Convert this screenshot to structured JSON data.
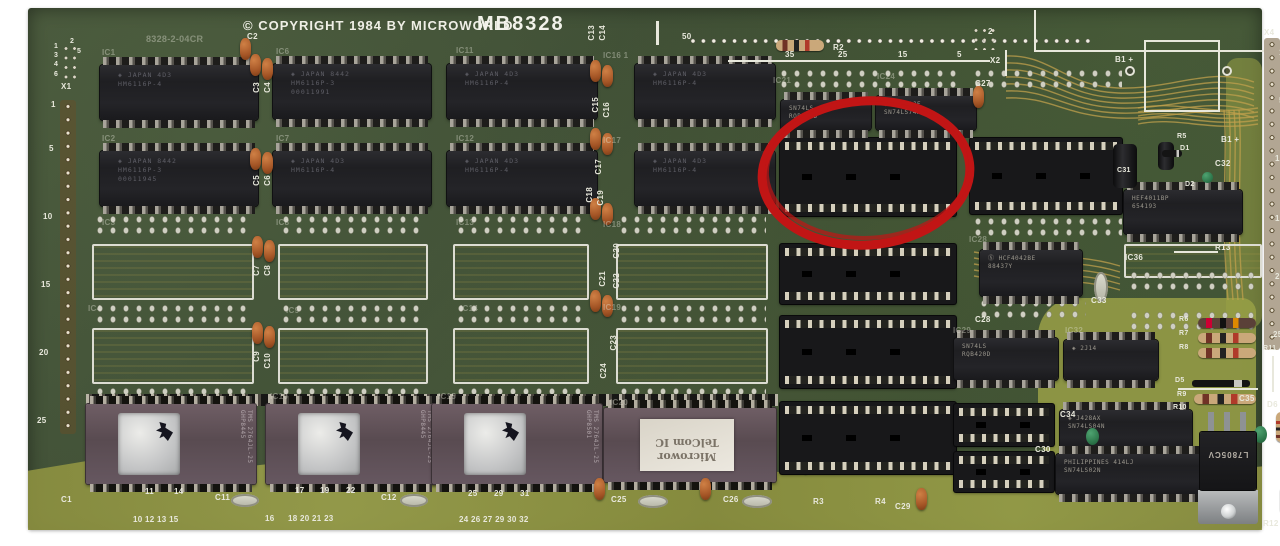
{
  "title": {
    "copyright": "© COPYRIGHT 1984 BY MICROWORLD",
    "model": "MB8328"
  },
  "colors": {
    "board_green": "#44523a",
    "silkscreen": "#e8e8dc",
    "trace_gold": "#c0a04c",
    "annotation_red": "#c11515"
  },
  "annotation": {
    "cx": 838,
    "cy": 165,
    "rx": 104,
    "ry": 72,
    "rot": -4,
    "color": "#c11515",
    "width": 9
  },
  "ram_chips": [
    {
      "x": 72,
      "y": 57,
      "w": 158,
      "h": 55,
      "l": [
        "◈ JAPAN 4D3",
        "HM6116P-4"
      ]
    },
    {
      "x": 245,
      "y": 56,
      "w": 158,
      "h": 55,
      "l": [
        "◈ JAPAN 8442",
        "HM6116P-3",
        "00011991"
      ]
    },
    {
      "x": 419,
      "y": 56,
      "w": 150,
      "h": 55,
      "l": [
        "◈ JAPAN 4D3",
        "HM6116P-4"
      ]
    },
    {
      "x": 607,
      "y": 56,
      "w": 140,
      "h": 55,
      "l": [
        "◈ JAPAN 4D3",
        "HM6116P-4"
      ]
    },
    {
      "x": 72,
      "y": 143,
      "w": 158,
      "h": 55,
      "l": [
        "◈ JAPAN 8442",
        "HM6116P-3",
        "00011945"
      ]
    },
    {
      "x": 245,
      "y": 143,
      "w": 158,
      "h": 55,
      "l": [
        "◈ JAPAN 4D3",
        "HM6116P-4"
      ]
    },
    {
      "x": 419,
      "y": 143,
      "w": 150,
      "h": 55,
      "l": [
        "◈ JAPAN 4D3",
        "HM6116P-4"
      ]
    },
    {
      "x": 607,
      "y": 143,
      "w": 140,
      "h": 55,
      "l": [
        "◈ JAPAN 4D3",
        "HM6116P-4"
      ]
    }
  ],
  "small_chips": [
    {
      "x": 753,
      "y": 92,
      "w": 90,
      "h": 30,
      "l": [
        "SN74LS",
        "RQB420D"
      ]
    },
    {
      "x": 848,
      "y": 88,
      "w": 100,
      "h": 34,
      "l": [
        "◈ J445AJF",
        "SN74LS74AN"
      ]
    },
    {
      "x": 952,
      "y": 242,
      "w": 102,
      "h": 46,
      "l": [
        "Ⓢ HCF4042BE",
        "88437Y"
      ]
    },
    {
      "x": 926,
      "y": 330,
      "w": 104,
      "h": 42,
      "l": [
        "SN74LS",
        "RQB420D"
      ]
    },
    {
      "x": 1036,
      "y": 332,
      "w": 94,
      "h": 40,
      "l": [
        "◈ 2J14"
      ]
    },
    {
      "x": 1096,
      "y": 182,
      "w": 118,
      "h": 44,
      "l": [
        "HEF4011BP",
        "654193"
      ]
    },
    {
      "x": 1032,
      "y": 402,
      "w": 132,
      "h": 40,
      "l": [
        "◈ J428AX",
        "SN74LS04N"
      ]
    },
    {
      "x": 1028,
      "y": 446,
      "w": 148,
      "h": 40,
      "l": [
        "PHILIPPINES 414LJ",
        "SN74LS02N"
      ]
    }
  ],
  "sockets": [
    {
      "x": 752,
      "y": 130,
      "w": 176,
      "h": 78
    },
    {
      "x": 752,
      "y": 236,
      "w": 176,
      "h": 60
    },
    {
      "x": 752,
      "y": 308,
      "w": 176,
      "h": 72
    },
    {
      "x": 752,
      "y": 394,
      "w": 176,
      "h": 72
    },
    {
      "x": 942,
      "y": 130,
      "w": 152,
      "h": 76
    },
    {
      "x": 926,
      "y": 396,
      "w": 100,
      "h": 42
    },
    {
      "x": 926,
      "y": 444,
      "w": 100,
      "h": 40
    }
  ],
  "eproms": [
    {
      "x": 58,
      "y": 396,
      "w": 170,
      "h": 80,
      "side": "TMS 2764JL-25 GHP8445"
    },
    {
      "x": 238,
      "y": 396,
      "w": 170,
      "h": 80,
      "side": "TMS 2764JL-25 GHP8445"
    },
    {
      "x": 404,
      "y": 396,
      "w": 170,
      "h": 80,
      "side": "TMS 2764JL-25 GHP8501"
    },
    {
      "x": 576,
      "y": 400,
      "w": 172,
      "h": 74,
      "type": "label",
      "lines": [
        "Microwor",
        "TelCom IC"
      ]
    }
  ],
  "footprints": [
    {
      "x": 64,
      "y": 236,
      "w": 162,
      "h": 56
    },
    {
      "x": 250,
      "y": 236,
      "w": 150,
      "h": 56
    },
    {
      "x": 425,
      "y": 236,
      "w": 136,
      "h": 56
    },
    {
      "x": 588,
      "y": 236,
      "w": 152,
      "h": 56
    },
    {
      "x": 64,
      "y": 320,
      "w": 162,
      "h": 56
    },
    {
      "x": 250,
      "y": 320,
      "w": 150,
      "h": 56
    },
    {
      "x": 425,
      "y": 320,
      "w": 136,
      "h": 56
    },
    {
      "x": 588,
      "y": 320,
      "w": 152,
      "h": 56
    },
    {
      "x": 1096,
      "y": 236,
      "w": 138,
      "h": 34
    }
  ],
  "pad_rows": [
    {
      "x": 66,
      "y": 206,
      "w": 158
    },
    {
      "x": 252,
      "y": 206,
      "w": 146
    },
    {
      "x": 427,
      "y": 206,
      "w": 132
    },
    {
      "x": 590,
      "y": 206,
      "w": 148
    },
    {
      "x": 66,
      "y": 295,
      "w": 158
    },
    {
      "x": 252,
      "y": 295,
      "w": 146
    },
    {
      "x": 427,
      "y": 295,
      "w": 132
    },
    {
      "x": 590,
      "y": 295,
      "w": 148
    },
    {
      "x": 66,
      "y": 378,
      "w": 158
    },
    {
      "x": 252,
      "y": 378,
      "w": 146
    },
    {
      "x": 427,
      "y": 378,
      "w": 132
    },
    {
      "x": 590,
      "y": 378,
      "w": 148
    },
    {
      "x": 750,
      "y": 60,
      "w": 182
    },
    {
      "x": 944,
      "y": 60,
      "w": 150
    },
    {
      "x": 944,
      "y": 208,
      "w": 150
    },
    {
      "x": 950,
      "y": 290,
      "w": 108
    },
    {
      "x": 1100,
      "y": 262,
      "w": 132
    },
    {
      "x": 1100,
      "y": 302,
      "w": 132
    }
  ],
  "dstrips": [
    {
      "x": 58,
      "y": 386,
      "w": 692,
      "h": 12
    }
  ],
  "caps": [
    {
      "x": 212,
      "y": 30
    },
    {
      "x": 222,
      "y": 46
    },
    {
      "x": 234,
      "y": 50
    },
    {
      "x": 222,
      "y": 140
    },
    {
      "x": 234,
      "y": 144
    },
    {
      "x": 224,
      "y": 228
    },
    {
      "x": 236,
      "y": 232
    },
    {
      "x": 224,
      "y": 314
    },
    {
      "x": 236,
      "y": 318
    },
    {
      "x": 562,
      "y": 52
    },
    {
      "x": 574,
      "y": 57
    },
    {
      "x": 562,
      "y": 120
    },
    {
      "x": 574,
      "y": 125
    },
    {
      "x": 562,
      "y": 190
    },
    {
      "x": 574,
      "y": 195
    },
    {
      "x": 562,
      "y": 282
    },
    {
      "x": 574,
      "y": 287
    },
    {
      "x": 945,
      "y": 78
    },
    {
      "x": 566,
      "y": 470
    },
    {
      "x": 672,
      "y": 470
    },
    {
      "x": 888,
      "y": 480
    }
  ],
  "gcaps": [
    {
      "x": 1174,
      "y": 164,
      "w": 11,
      "h": 11
    },
    {
      "x": 1058,
      "y": 420,
      "w": 13,
      "h": 17
    },
    {
      "x": 1226,
      "y": 418,
      "w": 13,
      "h": 17
    }
  ],
  "bcaps": [
    {
      "x": 1085,
      "y": 136,
      "w": 24,
      "h": 44
    },
    {
      "x": 1130,
      "y": 134,
      "w": 16,
      "h": 28
    }
  ],
  "ovals": [
    {
      "x": 203,
      "y": 486,
      "w": 28,
      "h": 13
    },
    {
      "x": 372,
      "y": 486,
      "w": 28,
      "h": 13
    },
    {
      "x": 610,
      "y": 487,
      "w": 30,
      "h": 13
    },
    {
      "x": 714,
      "y": 487,
      "w": 30,
      "h": 13
    },
    {
      "x": 1010,
      "y": 406,
      "w": 14,
      "h": 30
    },
    {
      "x": 1066,
      "y": 264,
      "w": 14,
      "h": 30
    }
  ],
  "resistors": [
    {
      "x": 748,
      "y": 32,
      "w": 48,
      "h": 11
    },
    {
      "x": 1170,
      "y": 310,
      "w": 58,
      "h": 10,
      "dark": 1
    },
    {
      "x": 1170,
      "y": 325,
      "w": 58,
      "h": 10
    },
    {
      "x": 1170,
      "y": 340,
      "w": 58,
      "h": 10
    },
    {
      "x": 1166,
      "y": 386,
      "w": 62,
      "h": 10
    },
    {
      "x": 1248,
      "y": 404,
      "w": 10,
      "h": 30,
      "v": 1
    },
    {
      "x": 1252,
      "y": 478,
      "w": 10,
      "h": 28,
      "v": 1
    }
  ],
  "diodes": [
    {
      "x": 1164,
      "y": 372,
      "w": 58,
      "h": 7
    },
    {
      "x": 1134,
      "y": 142,
      "w": 20,
      "h": 7
    }
  ],
  "wlines": [
    {
      "x": 1006,
      "y": 2,
      "w": 2,
      "h": 41
    },
    {
      "x": 1006,
      "y": 42,
      "w": 230,
      "h": 2
    },
    {
      "x": 977,
      "y": 42,
      "w": 2,
      "h": 26
    },
    {
      "x": 700,
      "y": 52,
      "w": 262,
      "h": 2
    },
    {
      "x": 628,
      "y": 13,
      "w": 3,
      "h": 24
    },
    {
      "x": 1146,
      "y": 243,
      "w": 44,
      "h": 2
    },
    {
      "x": 1244,
      "y": 348,
      "w": 2,
      "h": 36
    },
    {
      "x": 1150,
      "y": 380,
      "w": 80,
      "h": 2
    }
  ],
  "boxes": [
    {
      "x": 1116,
      "y": 32,
      "w": 76,
      "h": 72
    }
  ],
  "vias": [
    {
      "x": 1097,
      "y": 58
    },
    {
      "x": 1194,
      "y": 58
    }
  ],
  "holes": [
    {
      "x": 660,
      "y": 27,
      "w": 406,
      "h": 12,
      "type": "row"
    },
    {
      "x": 32,
      "y": 92,
      "w": 16,
      "h": 334,
      "type": "col"
    },
    {
      "x": 1236,
      "y": 30,
      "w": 16,
      "h": 312,
      "type": "col"
    }
  ],
  "pgrids": [
    {
      "x": 34,
      "y": 36,
      "w": 17,
      "h": 38
    },
    {
      "x": 944,
      "y": 18,
      "w": 26,
      "h": 24
    }
  ],
  "regulator": {
    "x": 1172,
    "y": 424,
    "w": 56,
    "h": 58,
    "text": "L7805CV",
    "tab": 34
  },
  "silk": [
    {
      "t": "C2",
      "x": 219,
      "y": 25
    },
    {
      "t": "8328-2-04CR",
      "x": 118,
      "y": 27,
      "s": 9,
      "f": 1
    },
    {
      "t": "50",
      "x": 654,
      "y": 25
    },
    {
      "t": "35",
      "x": 757,
      "y": 43
    },
    {
      "t": "25",
      "x": 810,
      "y": 43
    },
    {
      "t": "15",
      "x": 870,
      "y": 43
    },
    {
      "t": "5",
      "x": 929,
      "y": 43
    },
    {
      "t": "2",
      "x": 960,
      "y": 20
    },
    {
      "t": "X2",
      "x": 962,
      "y": 49
    },
    {
      "t": "C27",
      "x": 947,
      "y": 72
    },
    {
      "t": "R2",
      "x": 805,
      "y": 36
    },
    {
      "t": "B1 +",
      "x": 1087,
      "y": 48
    },
    {
      "t": "B1 +",
      "x": 1193,
      "y": 128
    },
    {
      "t": "X4",
      "x": 1236,
      "y": 21
    },
    {
      "t": "R5",
      "x": 1149,
      "y": 125,
      "s": 7
    },
    {
      "t": "D1",
      "x": 1152,
      "y": 137,
      "s": 7
    },
    {
      "t": "C32",
      "x": 1187,
      "y": 152
    },
    {
      "t": "C31",
      "x": 1089,
      "y": 159,
      "s": 7
    },
    {
      "t": "D2",
      "x": 1157,
      "y": 173,
      "s": 7
    },
    {
      "t": "1",
      "x": 26,
      "y": 35,
      "s": 7
    },
    {
      "t": "2",
      "x": 42,
      "y": 30,
      "s": 7
    },
    {
      "t": "3",
      "x": 26,
      "y": 44,
      "s": 7
    },
    {
      "t": "5",
      "x": 49,
      "y": 40,
      "s": 7
    },
    {
      "t": "4",
      "x": 26,
      "y": 53,
      "s": 7
    },
    {
      "t": "6",
      "x": 26,
      "y": 63,
      "s": 7
    },
    {
      "t": "X1",
      "x": 33,
      "y": 75
    },
    {
      "t": "1",
      "x": 23,
      "y": 93
    },
    {
      "t": "5",
      "x": 21,
      "y": 137
    },
    {
      "t": "10",
      "x": 15,
      "y": 205
    },
    {
      "t": "15",
      "x": 13,
      "y": 273
    },
    {
      "t": "20",
      "x": 11,
      "y": 341
    },
    {
      "t": "25",
      "x": 9,
      "y": 409
    },
    {
      "t": "1",
      "x": 1251,
      "y": 41
    },
    {
      "t": "5",
      "x": 1251,
      "y": 89
    },
    {
      "t": "10",
      "x": 1247,
      "y": 147
    },
    {
      "t": "15",
      "x": 1247,
      "y": 207
    },
    {
      "t": "20",
      "x": 1247,
      "y": 265
    },
    {
      "t": "25",
      "x": 1245,
      "y": 323
    },
    {
      "t": "IC1",
      "x": 74,
      "y": 41,
      "f": 1
    },
    {
      "t": "IC6",
      "x": 248,
      "y": 40,
      "f": 1
    },
    {
      "t": "IC11",
      "x": 428,
      "y": 39,
      "f": 1
    },
    {
      "t": "IC16 1",
      "x": 575,
      "y": 44,
      "f": 1
    },
    {
      "t": "IC2",
      "x": 74,
      "y": 127,
      "f": 1
    },
    {
      "t": "IC7",
      "x": 248,
      "y": 127,
      "f": 1
    },
    {
      "t": "IC12",
      "x": 428,
      "y": 127,
      "f": 1
    },
    {
      "t": "IC17",
      "x": 575,
      "y": 129,
      "f": 1
    },
    {
      "t": "IC3",
      "x": 74,
      "y": 211,
      "f": 1
    },
    {
      "t": "IC8",
      "x": 248,
      "y": 211,
      "f": 1
    },
    {
      "t": "IC13",
      "x": 428,
      "y": 211,
      "f": 1
    },
    {
      "t": "IC18",
      "x": 575,
      "y": 213,
      "f": 1
    },
    {
      "t": "IC4",
      "x": 60,
      "y": 297,
      "f": 1
    },
    {
      "t": "IC9",
      "x": 258,
      "y": 299,
      "f": 1
    },
    {
      "t": "IC14",
      "x": 432,
      "y": 297,
      "f": 1
    },
    {
      "t": "IC19",
      "x": 575,
      "y": 296,
      "f": 1
    },
    {
      "t": "IC10",
      "x": 242,
      "y": 385,
      "f": 1
    },
    {
      "t": "IC15",
      "x": 410,
      "y": 385,
      "f": 1
    },
    {
      "t": "IC20",
      "x": 582,
      "y": 391,
      "f": 1
    },
    {
      "t": "IC21",
      "x": 745,
      "y": 69,
      "f": 1
    },
    {
      "t": "IC24",
      "x": 849,
      "y": 65,
      "f": 1
    },
    {
      "t": "IC28",
      "x": 941,
      "y": 228,
      "f": 1
    },
    {
      "t": "IC29",
      "x": 925,
      "y": 319,
      "f": 1
    },
    {
      "t": "IC32",
      "x": 1037,
      "y": 319,
      "f": 1
    },
    {
      "t": "IC36",
      "x": 1097,
      "y": 246
    },
    {
      "t": "C3",
      "x": 225,
      "y": 74,
      "r": 1
    },
    {
      "t": "C4",
      "x": 236,
      "y": 74,
      "r": 1
    },
    {
      "t": "C5",
      "x": 225,
      "y": 167,
      "r": 1
    },
    {
      "t": "C6",
      "x": 236,
      "y": 167,
      "r": 1
    },
    {
      "t": "C7",
      "x": 225,
      "y": 257,
      "r": 1
    },
    {
      "t": "C8",
      "x": 236,
      "y": 257,
      "r": 1
    },
    {
      "t": "C9",
      "x": 225,
      "y": 343,
      "r": 1
    },
    {
      "t": "C10",
      "x": 236,
      "y": 345,
      "r": 1
    },
    {
      "t": "C13",
      "x": 560,
      "y": 17,
      "r": 1
    },
    {
      "t": "C14",
      "x": 571,
      "y": 17,
      "r": 1
    },
    {
      "t": "C15",
      "x": 564,
      "y": 89,
      "r": 1
    },
    {
      "t": "C16",
      "x": 575,
      "y": 94,
      "r": 1
    },
    {
      "t": "C17",
      "x": 567,
      "y": 151,
      "r": 1
    },
    {
      "t": "C18",
      "x": 558,
      "y": 179,
      "r": 1
    },
    {
      "t": "C19",
      "x": 569,
      "y": 182,
      "r": 1
    },
    {
      "t": "C20",
      "x": 585,
      "y": 235,
      "r": 1
    },
    {
      "t": "C21",
      "x": 571,
      "y": 263,
      "r": 1
    },
    {
      "t": "C22",
      "x": 585,
      "y": 265,
      "r": 1
    },
    {
      "t": "C23",
      "x": 582,
      "y": 327,
      "r": 1
    },
    {
      "t": "C24",
      "x": 572,
      "y": 355,
      "r": 1
    },
    {
      "t": "R13",
      "x": 1187,
      "y": 236
    },
    {
      "t": "C33",
      "x": 1063,
      "y": 289
    },
    {
      "t": "C28",
      "x": 947,
      "y": 308
    },
    {
      "t": "R6",
      "x": 1151,
      "y": 308,
      "s": 7
    },
    {
      "t": "R7",
      "x": 1151,
      "y": 322,
      "s": 7
    },
    {
      "t": "R8",
      "x": 1151,
      "y": 336,
      "s": 7
    },
    {
      "t": "R11",
      "x": 1235,
      "y": 337,
      "s": 7
    },
    {
      "t": "D5",
      "x": 1147,
      "y": 369,
      "s": 7
    },
    {
      "t": "R9",
      "x": 1149,
      "y": 383,
      "s": 7
    },
    {
      "t": "R10",
      "x": 1145,
      "y": 396,
      "s": 7
    },
    {
      "t": "C35",
      "x": 1211,
      "y": 387
    },
    {
      "t": "C34",
      "x": 1032,
      "y": 403
    },
    {
      "t": "D6",
      "x": 1239,
      "y": 393
    },
    {
      "t": "R12",
      "x": 1235,
      "y": 512
    },
    {
      "t": "C30",
      "x": 1007,
      "y": 438
    },
    {
      "t": "C25",
      "x": 583,
      "y": 488
    },
    {
      "t": "C26",
      "x": 695,
      "y": 488
    },
    {
      "t": "C1",
      "x": 33,
      "y": 488
    },
    {
      "t": "C11",
      "x": 187,
      "y": 486
    },
    {
      "t": "C12",
      "x": 353,
      "y": 486
    },
    {
      "t": "R3",
      "x": 785,
      "y": 490
    },
    {
      "t": "R4",
      "x": 847,
      "y": 490
    },
    {
      "t": "C29",
      "x": 867,
      "y": 495
    },
    {
      "t": "11",
      "x": 117,
      "y": 480
    },
    {
      "t": "14",
      "x": 146,
      "y": 480
    },
    {
      "t": "10 12 13 15",
      "x": 105,
      "y": 508
    },
    {
      "t": "17",
      "x": 267,
      "y": 479
    },
    {
      "t": "19",
      "x": 292,
      "y": 479
    },
    {
      "t": "22",
      "x": 318,
      "y": 479
    },
    {
      "t": "16",
      "x": 237,
      "y": 507
    },
    {
      "t": "18 20 21 23",
      "x": 260,
      "y": 507
    },
    {
      "t": "25",
      "x": 440,
      "y": 482
    },
    {
      "t": "29",
      "x": 466,
      "y": 482
    },
    {
      "t": "31",
      "x": 492,
      "y": 482
    },
    {
      "t": "24 26 27 29 30 32",
      "x": 431,
      "y": 508
    }
  ]
}
